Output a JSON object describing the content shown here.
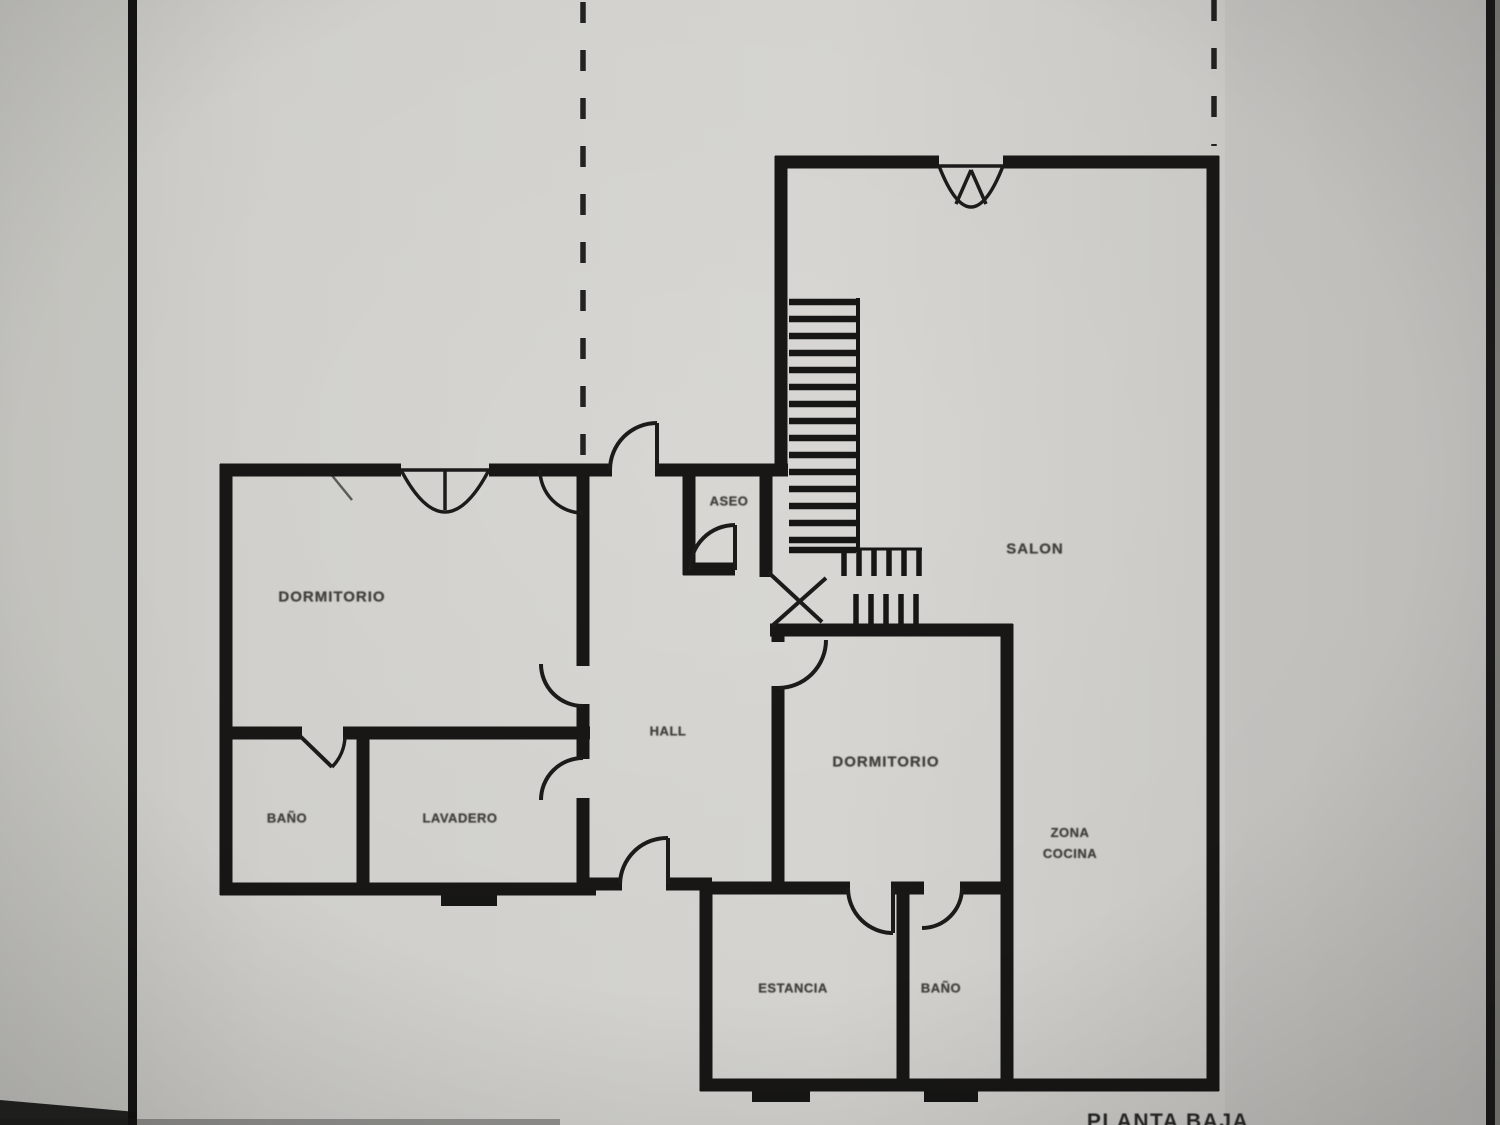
{
  "photo": {
    "type": "scanned floor plan",
    "plan_title": "PLANTA BAJA"
  },
  "rooms": {
    "dormitorio1": {
      "label": "DORMITORIO"
    },
    "bano1": {
      "label": "BAÑO"
    },
    "lavadero": {
      "label": "LAVADERO"
    },
    "hall": {
      "label": "HALL"
    },
    "aseo": {
      "label": "ASEO"
    },
    "salon": {
      "label": "SALON"
    },
    "dormitorio2": {
      "label": "DORMITORIO"
    },
    "zona_cocina": {
      "line1": "ZONA",
      "line2": "COCINA"
    },
    "estancia": {
      "label": "ESTANCIA"
    },
    "bano2": {
      "label": "BAÑO"
    }
  },
  "colors": {
    "background": "#cfcecb",
    "paper_light": "#d8d7d3",
    "wall": "#181715",
    "label_text": "#403f3c",
    "border_bar": "#141414"
  }
}
